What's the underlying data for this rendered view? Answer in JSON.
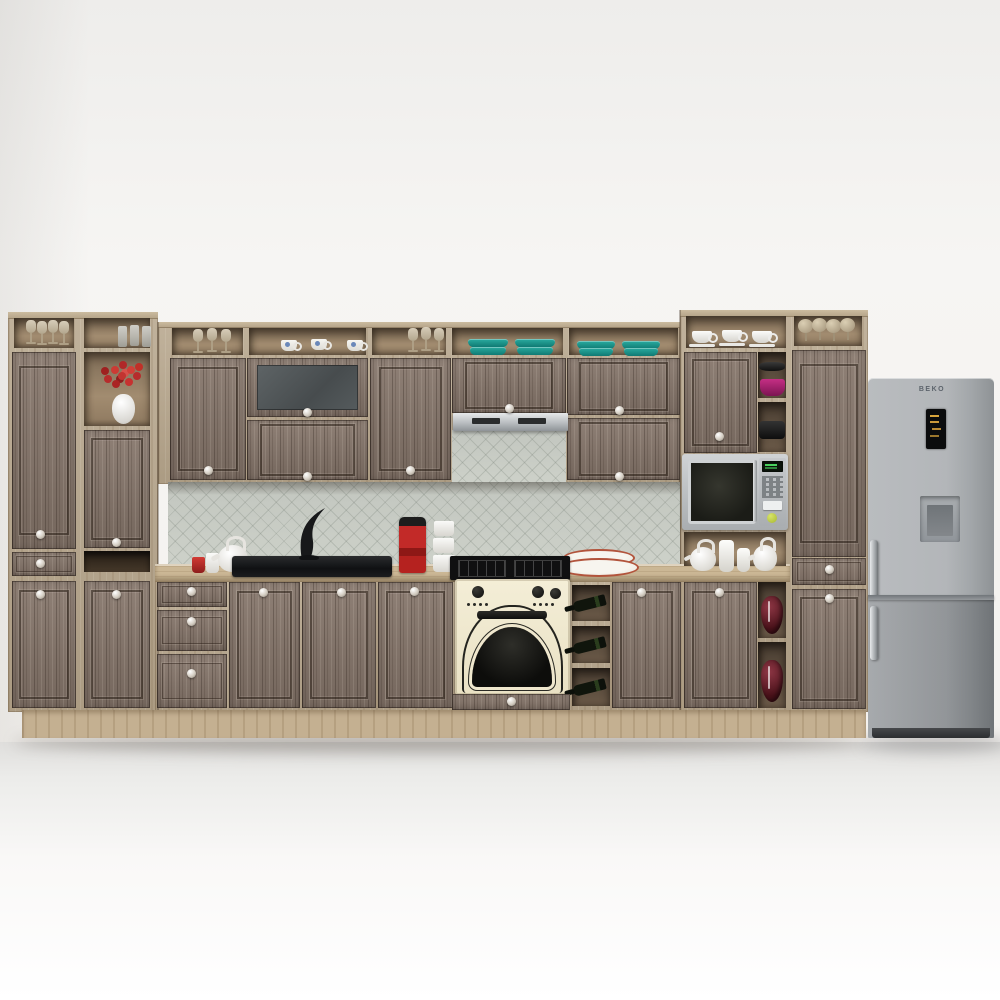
{
  "scene": {
    "title": "Rustic grey-wood kitchen set with appliances, 3D render",
    "setting": "white wall, light grey floor",
    "wall_color": "#f4f2ef",
    "floor_color": "#ececea"
  },
  "palette": {
    "door_wood": "#85756a",
    "carcass_wood": "#b6a58b",
    "countertop": "#cbb795",
    "plinth": "#c4b091",
    "backsplash_tile": "#c7cbc3",
    "oven_cream": "#f1ead1",
    "appliance_silver": "#b9bcbf",
    "hood_steel": "#b9bdc0",
    "teal_dishes": "#1d9d94",
    "flower_red": "#c03028",
    "wine_bottle_green": "#2a3d1d",
    "vase_maroon": "#6a2430",
    "sink_black": "#141517"
  },
  "fridge": {
    "brand": "BEKO",
    "type": "bottom-freezer with water dispenser",
    "finish": "stainless silver"
  },
  "inventory": {
    "top_shelves": [
      "wine glasses",
      "tumbler glasses",
      "stem glasses",
      "white cups with blue pattern",
      "stem glasses",
      "teal casserole dishes",
      "teal plate stacks",
      "white cups with saucers",
      "balloon glasses"
    ],
    "open_niches": [
      "red flower bouquet in white vase",
      "black plates and magenta bowl",
      "white teapots and jars",
      "maroon vases",
      "wine bottles"
    ],
    "counter_items": [
      "red cup",
      "white mug",
      "white teapot",
      "black sink with designer faucet",
      "red capsule coffee machine",
      "white cup stack",
      "white plates with terracotta rim"
    ],
    "appliances": [
      "range hood",
      "gas cooktop",
      "cream retro oven",
      "microwave oven",
      "BEKO fridge freezer"
    ]
  }
}
